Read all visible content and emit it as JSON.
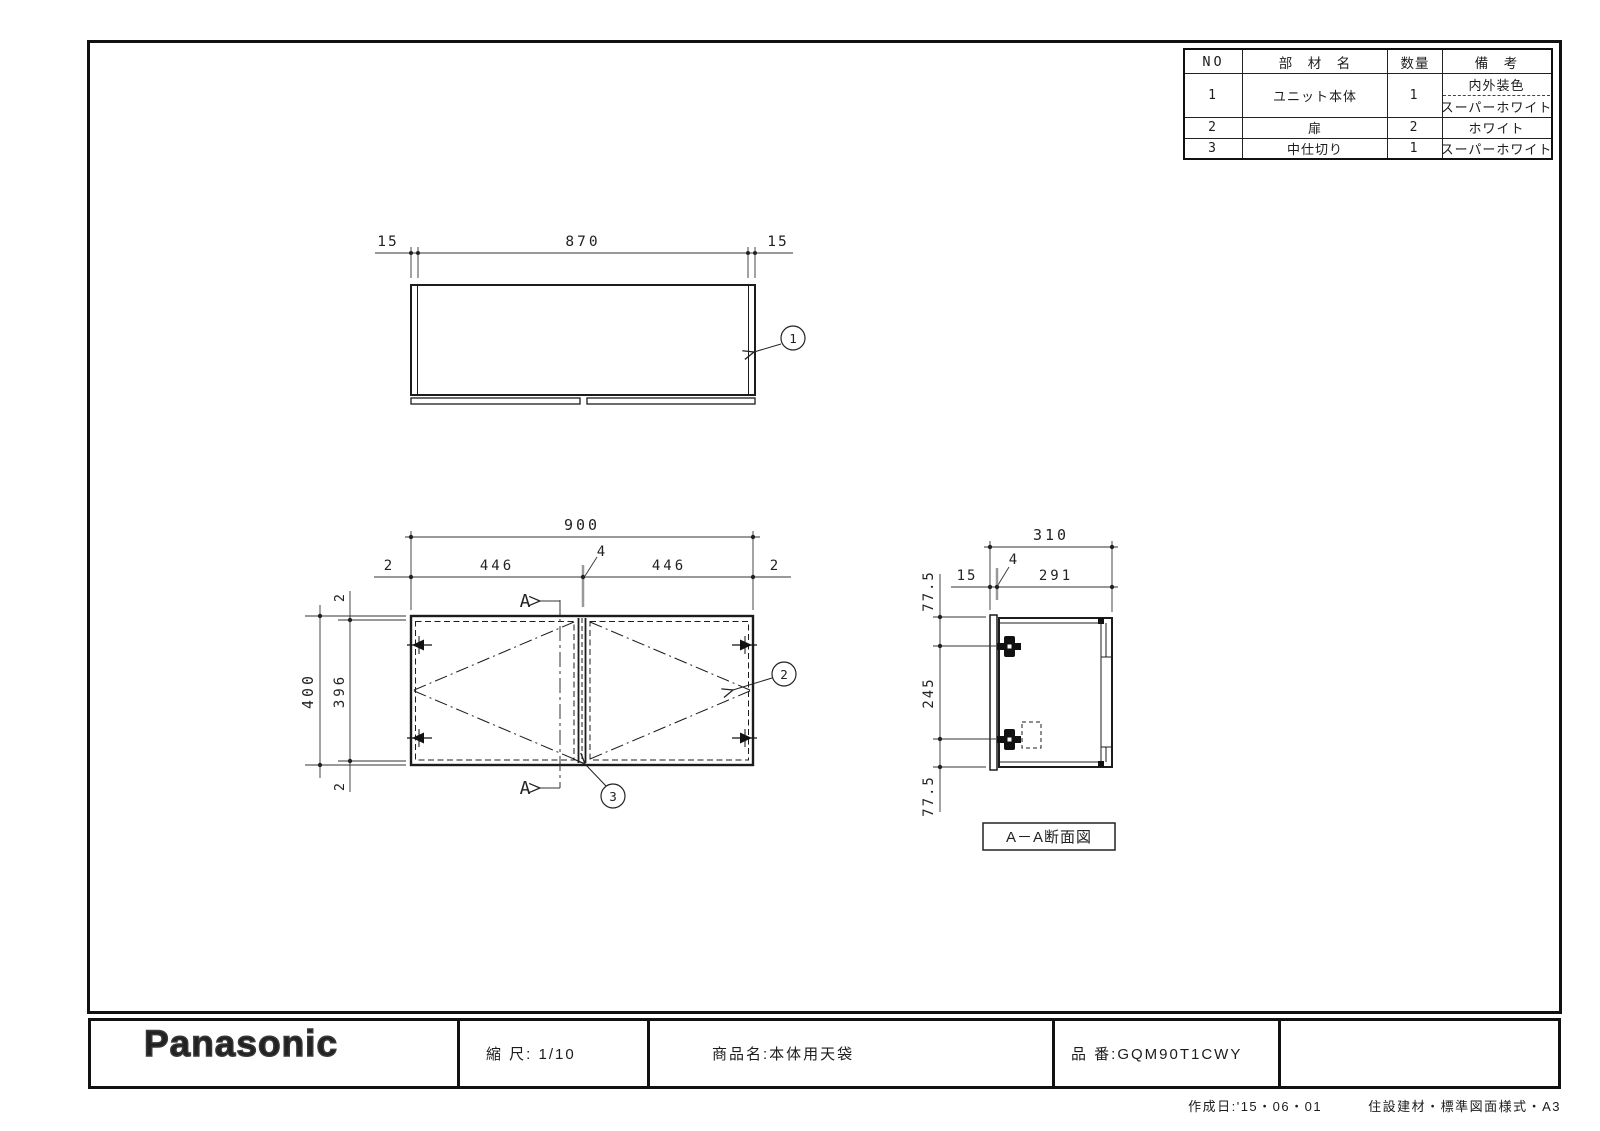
{
  "drawing": {
    "balloons": {
      "b1": "1",
      "b2": "2",
      "b3": "3"
    },
    "section_letter_top": "A",
    "section_letter_bottom": "A",
    "section_label": "A－A断面図",
    "top_view": {
      "dim_left": "15",
      "dim_center": "870",
      "dim_right": "15"
    },
    "front_view": {
      "dim_total": "900",
      "dim_edge_left": "2",
      "dim_door_left": "446",
      "dim_divider": "4",
      "dim_door_right": "446",
      "dim_edge_right": "2",
      "dim_height": "400",
      "dim_height_inner": "396",
      "dim_top_gap": "2",
      "dim_bottom_gap": "2"
    },
    "side_view": {
      "dim_depth": "310",
      "dim_door_thickness": "15",
      "dim_divider": "4",
      "dim_inner_depth": "291",
      "dim_top": "77.5",
      "dim_mid": "245",
      "dim_bottom": "77.5"
    }
  },
  "parts_table": {
    "headers": {
      "no": "NO",
      "name": "部　材　名",
      "qty": "数量",
      "remarks": "備　考"
    },
    "rows": [
      {
        "no": "1",
        "name": "ユニット本体",
        "qty": "1",
        "remarks_line1": "内外装色",
        "remarks_line2": "スーパーホワイト"
      },
      {
        "no": "2",
        "name": "扉",
        "qty": "2",
        "remarks": "ホワイト"
      },
      {
        "no": "3",
        "name": "中仕切り",
        "qty": "1",
        "remarks": "スーパーホワイト"
      }
    ]
  },
  "title_block": {
    "brand": "Panasonic",
    "scale": "縮 尺: 1/10",
    "product": "商品名:本体用天袋",
    "part_number": "品 番:GQM90T1CWY"
  },
  "footer": {
    "created": "作成日:'15・06・01",
    "standard": "住設建材・標準図面様式・A3"
  }
}
